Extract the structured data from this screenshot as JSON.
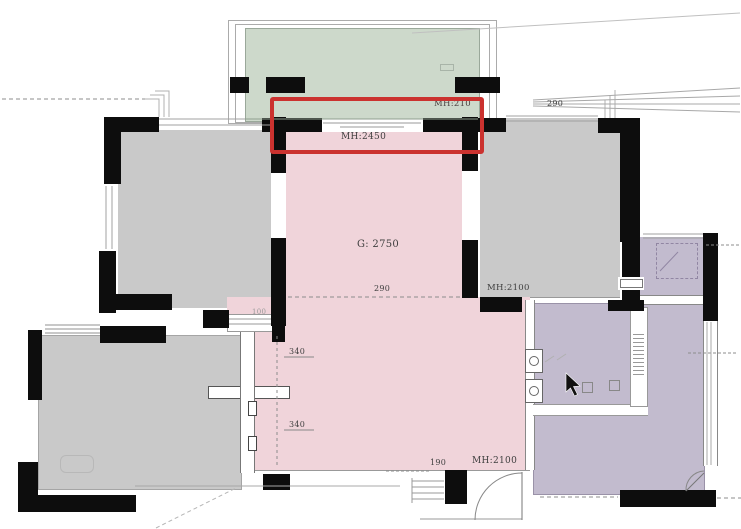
{
  "plan_title": "apartment-floor-plan",
  "colors": {
    "room_gray": "#c9c9c9",
    "room_pink": "#f0d4da",
    "room_green": "#cdd9cb",
    "room_purple": "#c2bbce",
    "wall_black": "#0d0d0d",
    "highlight_red": "#cb322f",
    "text_dark": "#3f3f3f"
  },
  "labels": {
    "balcony_door_height": "MH:210",
    "window_height": "MH:2450",
    "ceiling_height": "G: 2750",
    "beam_290": "290",
    "dim_290_top": "290",
    "door_height_right": "MH:2100",
    "beam_340_upper": "340",
    "beam_340_lower": "340",
    "dim_100": "100",
    "beam_190": "190",
    "door_height_entry": "MH:2100"
  },
  "icons": {
    "cursor": "mouse-pointer"
  },
  "highlight": {
    "purpose": "red-annotation-box-around-balcony-window"
  }
}
